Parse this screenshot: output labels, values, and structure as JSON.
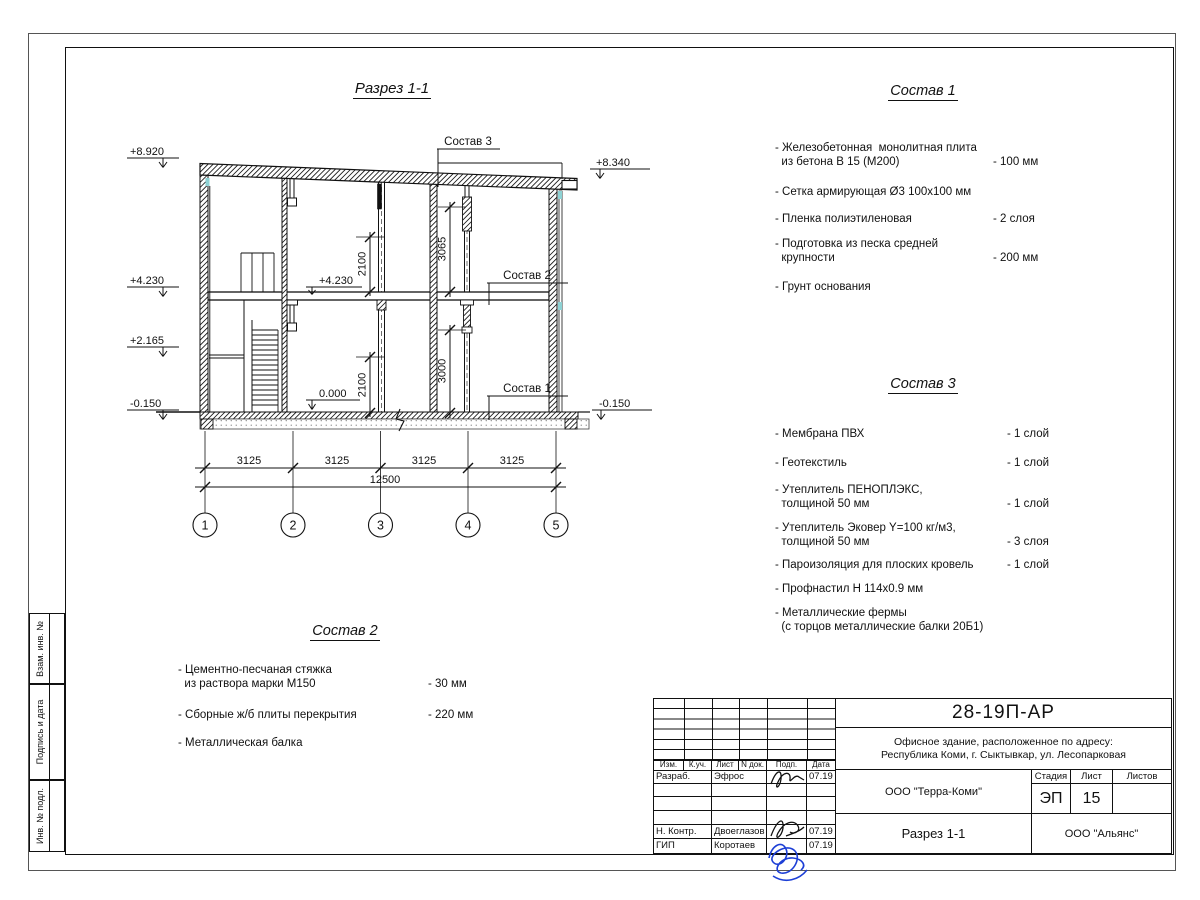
{
  "drawing": {
    "title": "Разрез 1-1",
    "elevations": {
      "roof_left": "+8.920",
      "floor2_left": "+4.230",
      "landing_left": "+2.165",
      "ground_left": "-0.150",
      "roof_right": "+8.340",
      "ground_right": "-0.150",
      "floor2_inner": "+4.230",
      "zero_inner": "0.000"
    },
    "dims": {
      "bays": [
        "3125",
        "3125",
        "3125",
        "3125"
      ],
      "total": "12500",
      "room_upper": "2100",
      "room_lower": "2100",
      "clear_upper": "3065",
      "clear_lower": "3000"
    },
    "axes": [
      "1",
      "2",
      "3",
      "4",
      "5"
    ],
    "leaders": {
      "s1": "Состав 1",
      "s2": "Состав 2",
      "s3": "Состав 3"
    }
  },
  "sostav1": {
    "title": "Состав 1",
    "items": [
      {
        "name": "- Железобетонная  монолитная плита\n  из бетона В 15 (М200)",
        "value": "- 100 мм"
      },
      {
        "name": "- Сетка армирующая Ø3 100х100 мм",
        "value": ""
      },
      {
        "name": "- Пленка полиэтиленовая",
        "value": "-  2 слоя"
      },
      {
        "name": "- Подготовка из песка средней\n  крупности",
        "value": "- 200 мм"
      },
      {
        "name": "- Грунт основания",
        "value": ""
      }
    ]
  },
  "sostav2": {
    "title": "Состав 2",
    "items": [
      {
        "name": "- Цементно-песчаная стяжка\n  из раствора марки М150",
        "value": "- 30 мм"
      },
      {
        "name": "- Сборные ж/б плиты перекрытия",
        "value": "- 220 мм"
      },
      {
        "name": "- Металлическая балка",
        "value": ""
      }
    ]
  },
  "sostav3": {
    "title": "Состав 3",
    "items": [
      {
        "name": "- Мембрана ПВХ",
        "value": "- 1 слой"
      },
      {
        "name": "- Геотекстиль",
        "value": "- 1 слой"
      },
      {
        "name": "- Утеплитель ПЕНОПЛЭКС,\n  толщиной 50 мм",
        "value": "- 1 слой"
      },
      {
        "name": "- Утеплитель Эковер Y=100 кг/м3,\n  толщиной 50 мм",
        "value": "- 3 слоя"
      },
      {
        "name": "- Пароизоляция для плоских кровель",
        "value": "- 1 слой"
      },
      {
        "name": "- Профнастил Н 114х0.9 мм",
        "value": ""
      },
      {
        "name": "- Металлические фермы\n  (с торцов металлические балки 20Б1)",
        "value": ""
      }
    ]
  },
  "stamp": {
    "doc_number": "28-19П-АР",
    "address_line1": "Офисное здание, расположенное по адресу:",
    "address_line2": "Республика Коми, г. Сыктывкар, ул. Лесопарковая",
    "org": "ООО \"Терра-Коми\"",
    "section_title": "Разрез 1-1",
    "contractor": "ООО \"Альянс\"",
    "stage_label": "Стадия",
    "sheet_label": "Лист",
    "sheets_label": "Листов",
    "stage": "ЭП",
    "sheet_no": "15",
    "header": [
      "Изм.",
      "К.уч.",
      "Лист",
      "N док.",
      "Подп.",
      "Дата"
    ],
    "rows": [
      {
        "role": "Разраб.",
        "name": "Эфрос",
        "date": "07.19"
      },
      {
        "role": "Н. Контр.",
        "name": "Двоеглазов",
        "date": "07.19"
      },
      {
        "role": "ГИП",
        "name": "Коротаев",
        "date": "07.19"
      }
    ]
  },
  "sidebar": {
    "items": [
      "Взам. инв. №",
      "Подпись и дата",
      "Инв. № подл."
    ]
  }
}
